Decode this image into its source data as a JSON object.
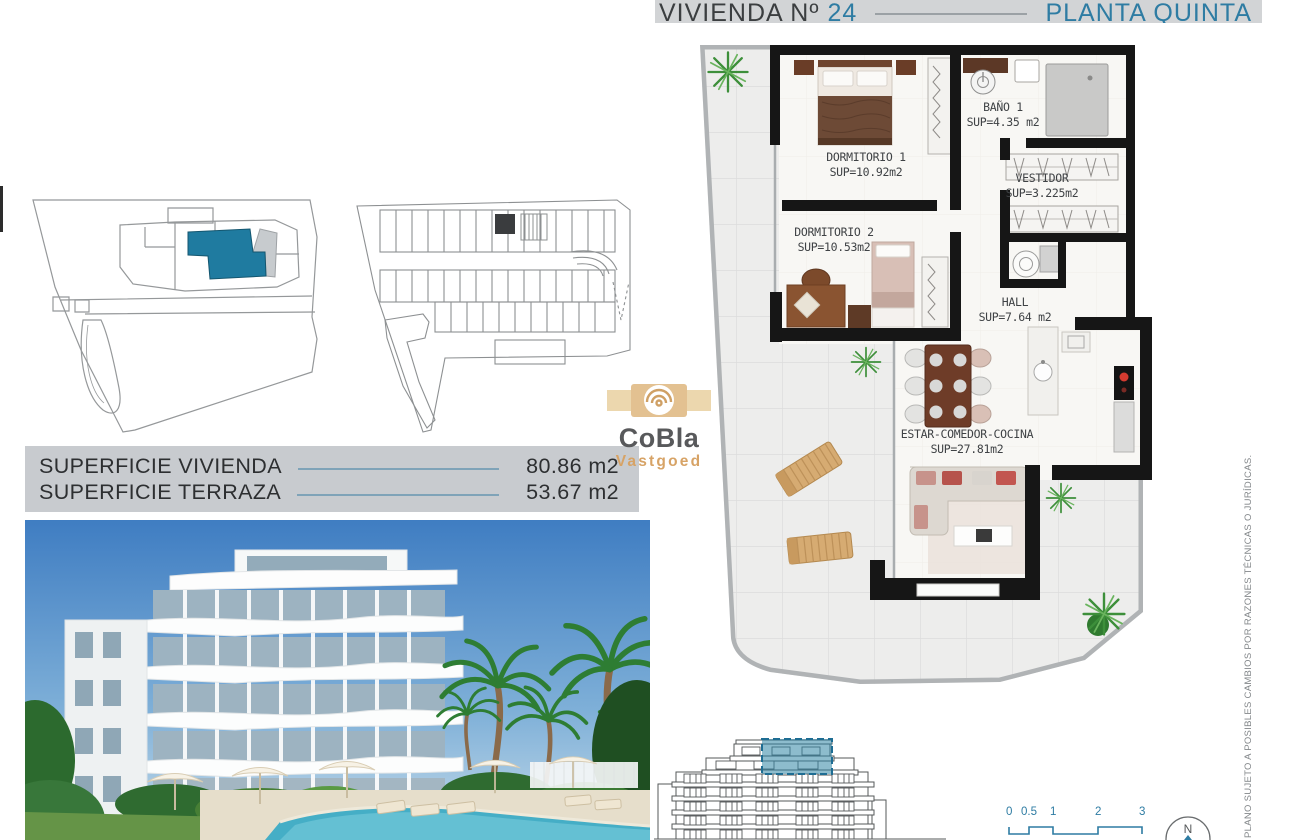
{
  "header": {
    "title": "VIVIENDA Nº",
    "number": "24",
    "floor": "PLANTA QUINTA"
  },
  "rooms": {
    "dormitorio1": {
      "name": "DORMITORIO 1",
      "area": "SUP=10.92m2"
    },
    "bano1": {
      "name": "BAÑO 1",
      "area": "SUP=4.35 m2"
    },
    "vestidor": {
      "name": "VESTIDOR",
      "area": "SUP=3.225m2"
    },
    "dormitorio2": {
      "name": "DORMITORIO 2",
      "area": "SUP=10.53m2"
    },
    "hall": {
      "name": "HALL",
      "area": "SUP=7.64 m2"
    },
    "estar": {
      "name": "ESTAR-COMEDOR-COCINA",
      "area": "SUP=27.81m2"
    }
  },
  "surfaces": {
    "rows": [
      {
        "label": "SUPERFICIE VIVIENDA",
        "value": "80.86 m2"
      },
      {
        "label": "SUPERFICIE TERRAZA",
        "value": "53.67 m2"
      }
    ]
  },
  "logo": {
    "brand": "CoBla",
    "sub": "Vastgoed"
  },
  "scalebar": {
    "ticks": [
      "0",
      "0.5",
      "1",
      "2",
      "3"
    ]
  },
  "north": "N",
  "disclaimer": "PLANO SUJETO A POSIBLES CAMBIOS POR RAZONES TÉCNICAS O JURÍDICAS.",
  "colors": {
    "accent": "#2e7ca3",
    "unit_highlight": "#1f7ba0",
    "header_bg": "#d2d4d6",
    "panel_bg": "#c8cbcf"
  }
}
